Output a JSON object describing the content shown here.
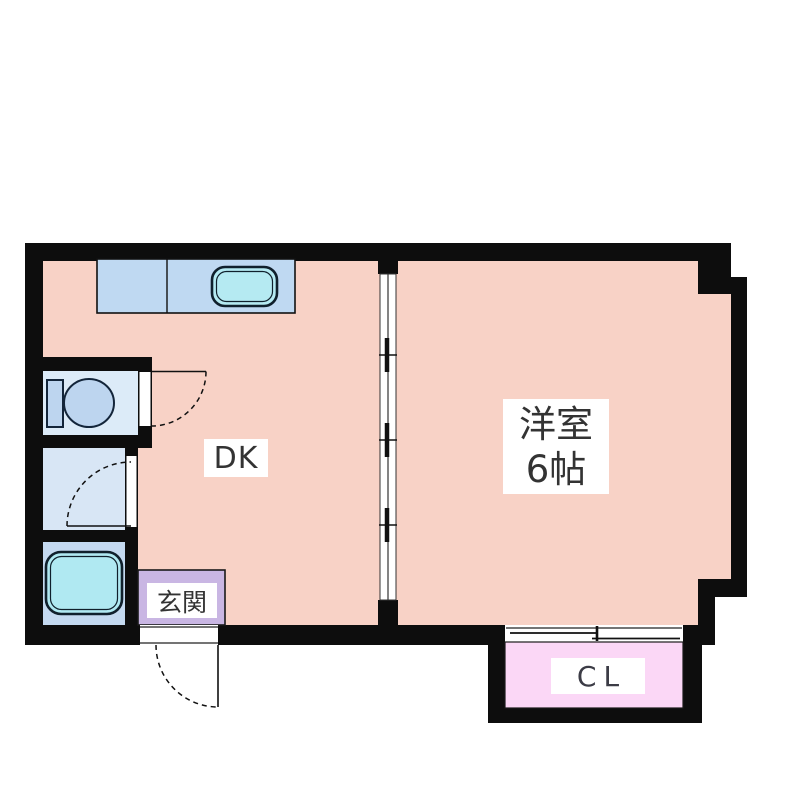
{
  "labels": {
    "dk": "DK",
    "living_room_line1": "洋室",
    "living_room_line2": "6帖",
    "entrance": "玄関",
    "closet": "CL"
  },
  "colors": {
    "wall": "#0d0d0d",
    "room": "#f8d2c6",
    "entrance": "#c9b6e3",
    "closet": "#fbd7f6",
    "toilet_room": "#dcebf8",
    "washroom": "#d8e6f5",
    "bathroom": "#c4d9f0",
    "counter": "#bfd9f2",
    "sink": "#b5eaf2",
    "tub": "#b0e9f2",
    "toilet_fixture": "#bdd5ef",
    "line": "#1a1a1a",
    "text": "#333333",
    "bg": "#ffffff"
  },
  "fixtures": {
    "kitchen_sink": "sink-icon",
    "toilet": "toilet-icon",
    "bathtub": "bathtub-icon",
    "entrance_door": "door-swing-icon",
    "toilet_door": "door-swing-icon",
    "washroom_door": "door-swing-icon",
    "room_divider": "sliding-door-icon",
    "closet_door": "sliding-door-icon"
  }
}
